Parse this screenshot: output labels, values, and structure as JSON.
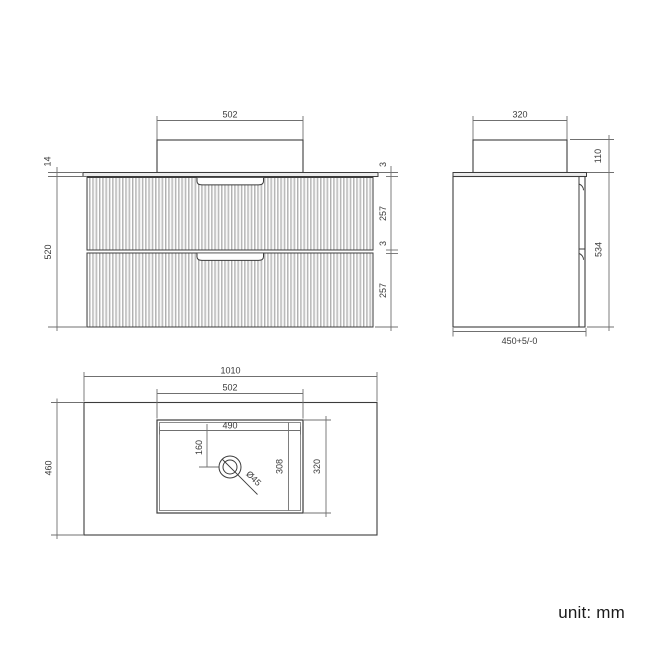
{
  "unit_note": "unit: mm",
  "colors": {
    "object_line": "#3c3c3c",
    "dimension_line": "#707070",
    "text": "#3a3a3a",
    "flute_fill": "#cdcdcd",
    "background": "#ffffff"
  },
  "front_view": {
    "dims": {
      "basin_width": "502",
      "countertop_thickness": "14",
      "cabinet_height": "520",
      "top_gap": "3",
      "drawer1_height": "257",
      "middle_gap": "3",
      "drawer2_height": "257"
    }
  },
  "side_view": {
    "dims": {
      "basin_depth": "320",
      "basin_height": "110",
      "total_height": "534",
      "cabinet_depth": "450+5/-0"
    }
  },
  "plan_view": {
    "dims": {
      "countertop_width": "1010",
      "sink_width": "502",
      "countertop_depth": "460",
      "bowl_width": "490",
      "drain_offset": "160",
      "bowl_depth": "308",
      "sink_depth": "320",
      "drain_diameter": "Ø45"
    }
  }
}
